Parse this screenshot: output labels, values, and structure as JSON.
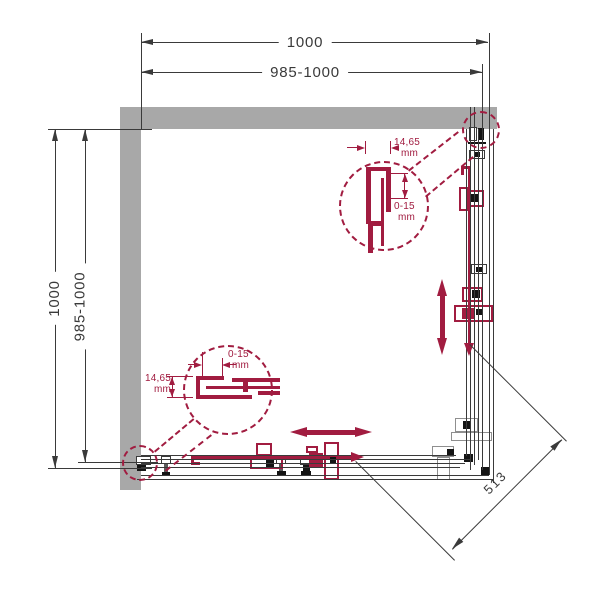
{
  "drawing": {
    "type": "technical-plan",
    "subject": "corner shower enclosure top view",
    "colors": {
      "accent_red": "#a11c40",
      "wall_gray": "#a8a8a8",
      "line_dark": "#3a3a3a"
    },
    "dimensions": {
      "top_outer": "1000",
      "top_adjustment": "985-1000",
      "left_outer": "1000",
      "left_adjustment": "985-1000",
      "diagonal_entry": "513"
    },
    "detail_top_right": {
      "profile_width": "14,65",
      "profile_width_unit": "mm",
      "adjustment_range": "0-15",
      "adjustment_range_unit": "mm"
    },
    "detail_bottom_left": {
      "adjustment_range": "0-15",
      "adjustment_range_unit": "mm",
      "profile_width": "14,65",
      "profile_width_unit": "mm"
    }
  }
}
